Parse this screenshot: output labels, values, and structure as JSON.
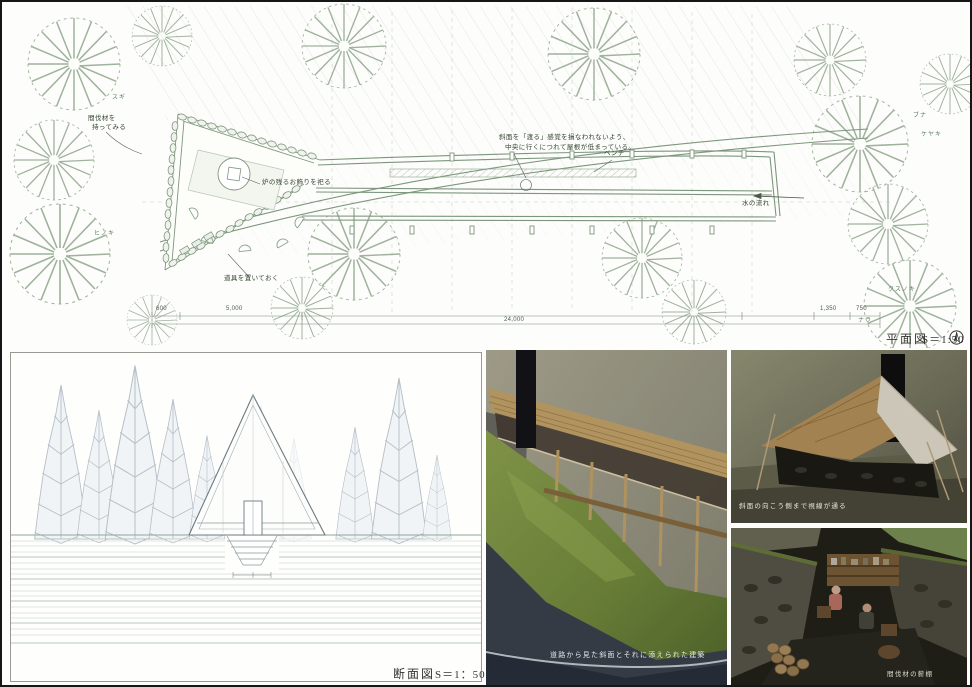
{
  "board": {
    "plan": {
      "title": "平面図",
      "scale": "S＝1:50",
      "annotations": {
        "roof_note_line1": "斜面を「渡る」感覚を損なわれないよう、",
        "roof_note_line2": "中央に行くにつれて屋根が低まっている。",
        "bench": "ベンチ",
        "water_flow": "水の流れ",
        "hearth": "炉の残るお飾りを祀る",
        "tools": "道具を置いておく",
        "thinned_line1": "間伐材を",
        "thinned_line2": "持ってみる"
      },
      "trees": [
        "スギ",
        "ヒノキ",
        "ブナ",
        "ケヤキ",
        "クスノキ",
        "ナラ"
      ],
      "dimensions": [
        "600",
        "5,000",
        "24,000",
        "1,350",
        "750"
      ]
    },
    "section": {
      "title": "断面図",
      "scale": "S＝1：50"
    },
    "photos": {
      "road_view_caption": "道路から見た斜面とそれに添えられた建築",
      "sightline_caption": "斜面の向こう側まで視線が通る",
      "woodshelf_caption": "間伐材の薪棚"
    },
    "colors": {
      "plan_line": "#8ba28b",
      "section_line": "#aab6bf",
      "moss": "#7f9444",
      "wood": "#c9a76b"
    }
  }
}
